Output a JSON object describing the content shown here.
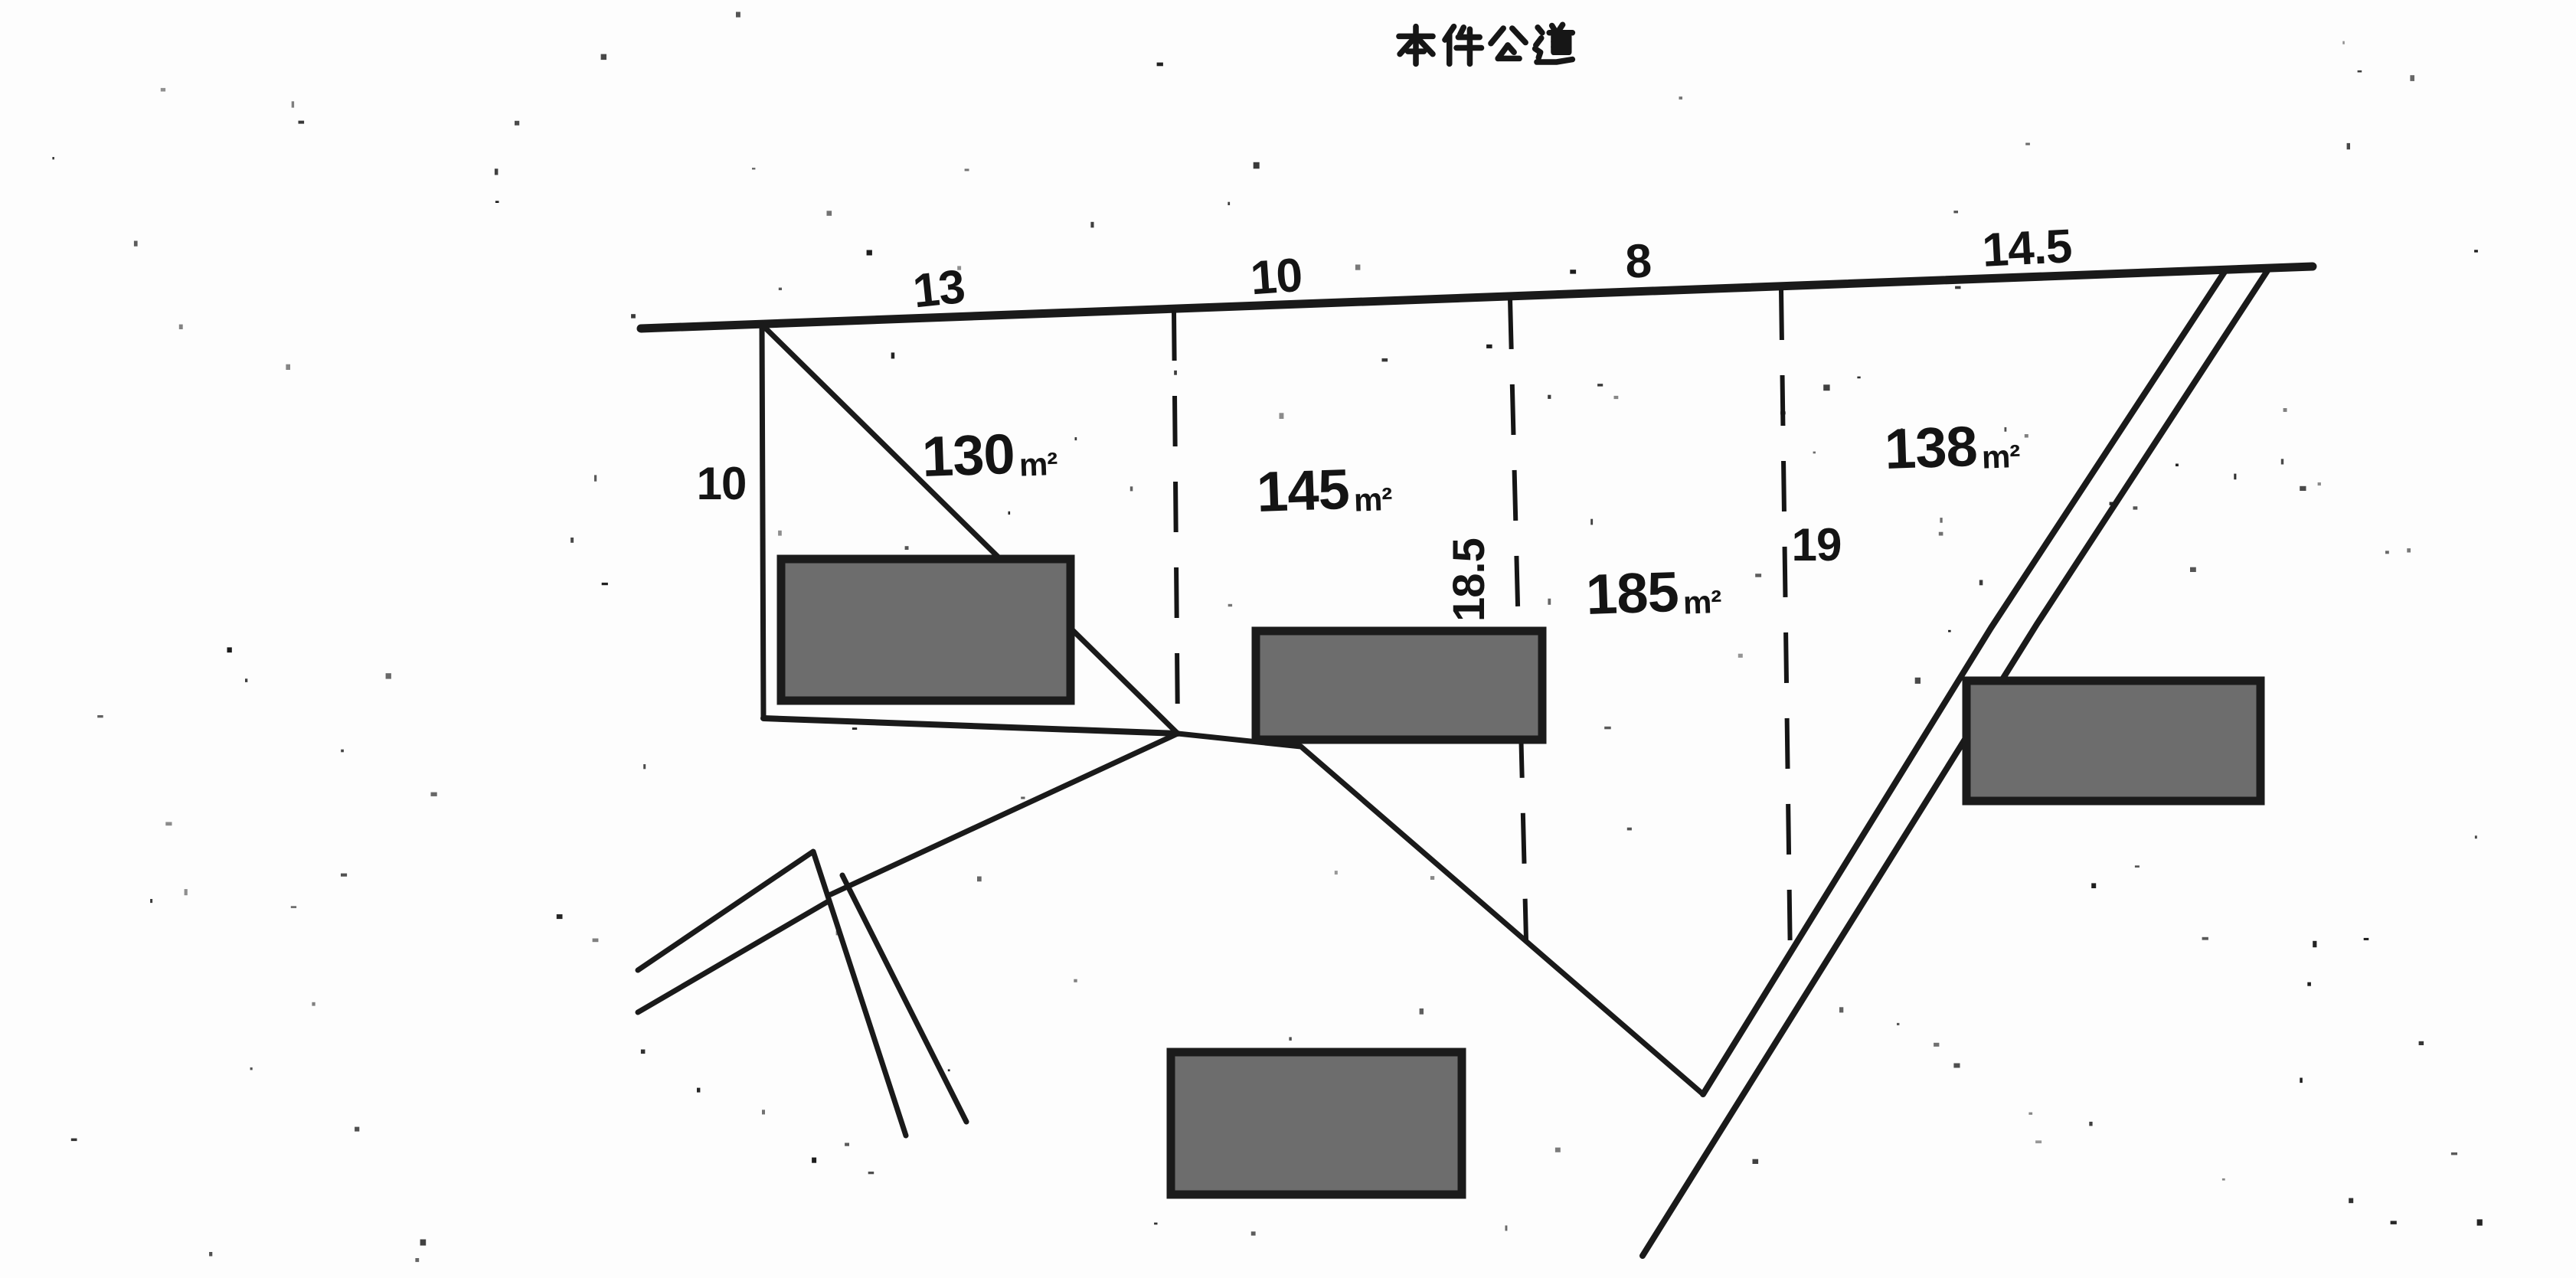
{
  "title": "本件公道",
  "sketch": {
    "top_edge_measurements": [
      {
        "label": "13"
      },
      {
        "label": "10"
      },
      {
        "label": "8"
      },
      {
        "label": "14.5"
      }
    ],
    "left_edge_measurement": "10",
    "divider_measurements": {
      "between_145_185": "18.5",
      "between_185_138": "19"
    },
    "parcels": [
      {
        "area": "130"
      },
      {
        "area": "145"
      },
      {
        "area": "185"
      },
      {
        "area": "138"
      }
    ],
    "area_unit": "m²"
  }
}
